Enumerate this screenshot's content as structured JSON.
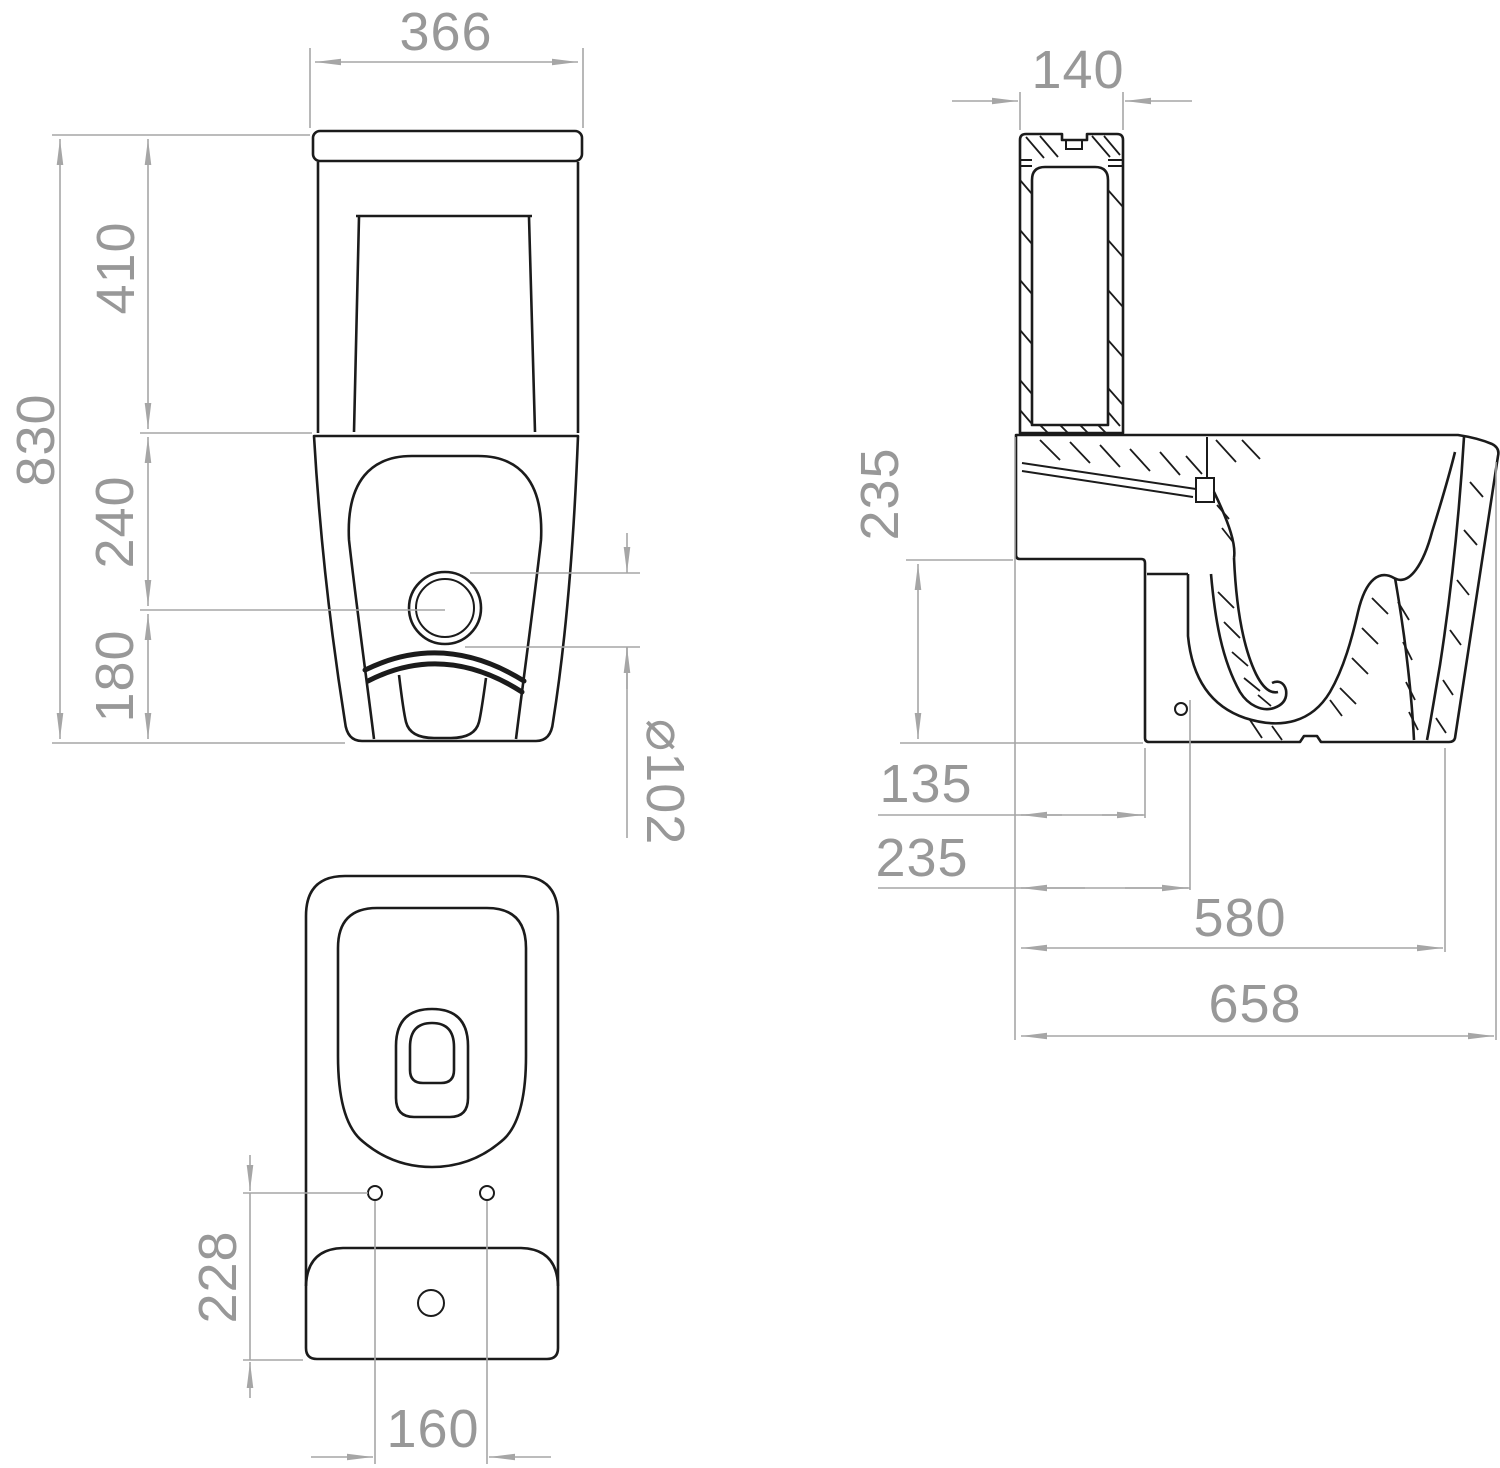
{
  "drawing": {
    "background": "#ffffff",
    "line_color": "#1b1b1b",
    "dimension_color": "#a6a6a6",
    "front_view": {
      "width": "366",
      "overall_height": "830",
      "cistern_height": "410",
      "cistern_to_outlet_center": "240",
      "outlet_center_to_floor": "180",
      "outlet_diameter": "⌀102"
    },
    "side_view": {
      "cistern_depth": "140",
      "rear_recess_height": "235",
      "rear_to_recess_depth": "135",
      "rear_to_trap_center": "235",
      "rear_to_bowl_front": "580",
      "overall_depth": "658"
    },
    "plan_view": {
      "fixing_hole_setback": "228",
      "fixing_hole_spacing": "160"
    }
  }
}
